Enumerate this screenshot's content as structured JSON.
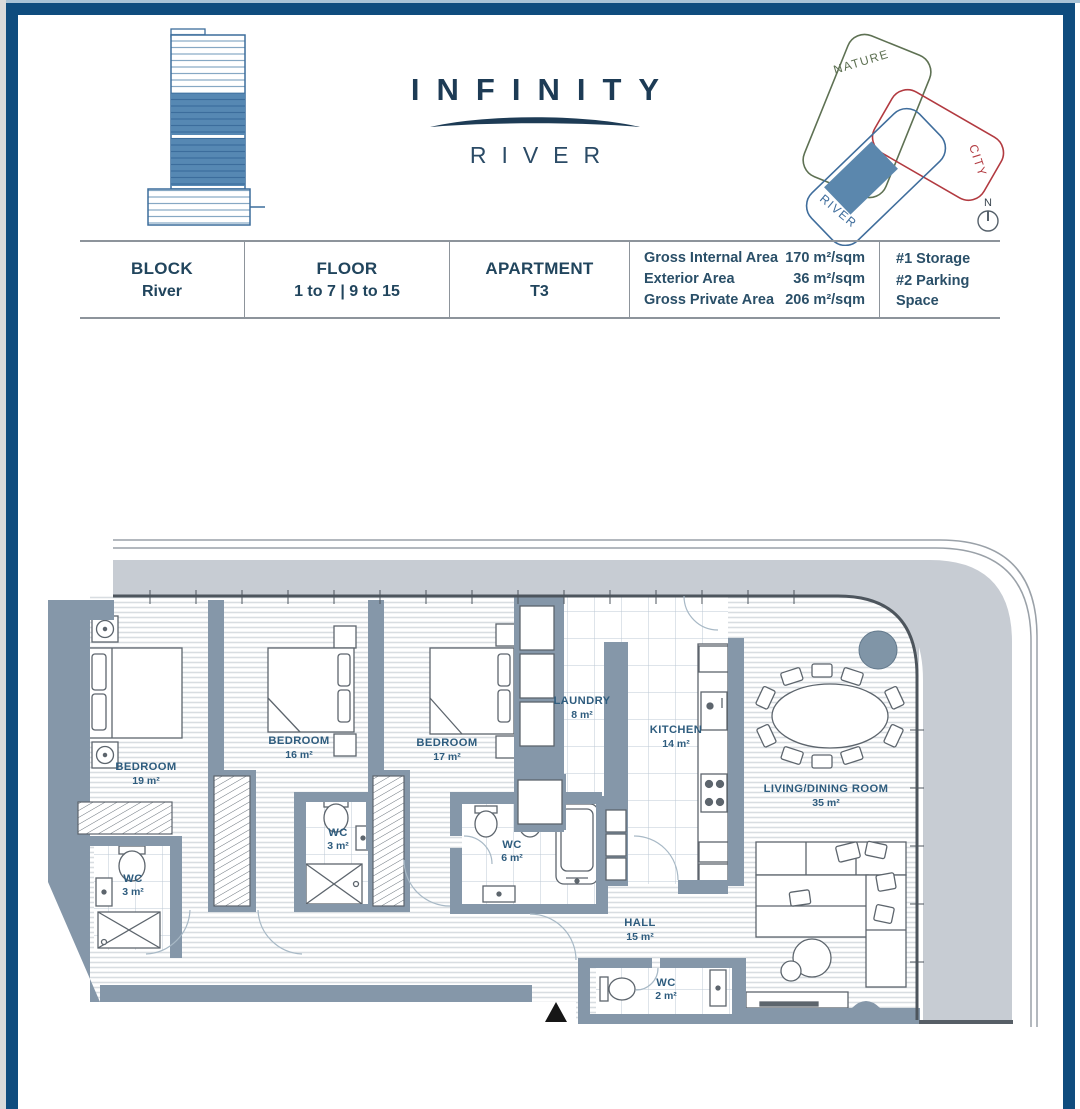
{
  "logo": {
    "title": "INFINITY",
    "subtitle": "RIVER"
  },
  "locator": {
    "labels": {
      "nature": "NATURE",
      "city": "CITY",
      "river": "RIVER"
    },
    "compass_label": "N"
  },
  "info_table": {
    "columns": [
      {
        "header": "BLOCK",
        "value": "River"
      },
      {
        "header": "FLOOR",
        "value": "1 to 7 | 9 to 15"
      },
      {
        "header": "APARTMENT",
        "value": "T3"
      }
    ],
    "areas": [
      {
        "label": "Gross Internal Area",
        "value": "170 m²/sqm"
      },
      {
        "label": "Exterior Area",
        "value": "36 m²/sqm"
      },
      {
        "label": "Gross Private Area",
        "value": "206 m²/sqm"
      }
    ],
    "extras": [
      "#1 Storage",
      "#2 Parking Space"
    ]
  },
  "plan": {
    "rooms": [
      {
        "name": "BEDROOM",
        "area": "19 m²"
      },
      {
        "name": "BEDROOM",
        "area": "16 m²"
      },
      {
        "name": "BEDROOM",
        "area": "17 m²"
      },
      {
        "name": "LAUNDRY",
        "area": "8 m²"
      },
      {
        "name": "KITCHEN",
        "area": "14 m²"
      },
      {
        "name": "LIVING/DINING ROOM",
        "area": "35 m²"
      },
      {
        "name": "WC",
        "area": "3 m²"
      },
      {
        "name": "WC",
        "area": "3 m²"
      },
      {
        "name": "WC",
        "area": "6 m²"
      },
      {
        "name": "HALL",
        "area": "15 m²"
      },
      {
        "name": "WC",
        "area": "2 m²"
      }
    ]
  },
  "colors": {
    "frame_navy": "#0f4c7e",
    "brand_navy": "#1d3b55",
    "wall_gray": "#8597a9",
    "terrace_gray": "#c7ccd3",
    "unit_blue": "#5b87ad",
    "nature_green": "#5e7153",
    "city_red": "#b23a40",
    "river_blue": "#3f6d9c"
  }
}
